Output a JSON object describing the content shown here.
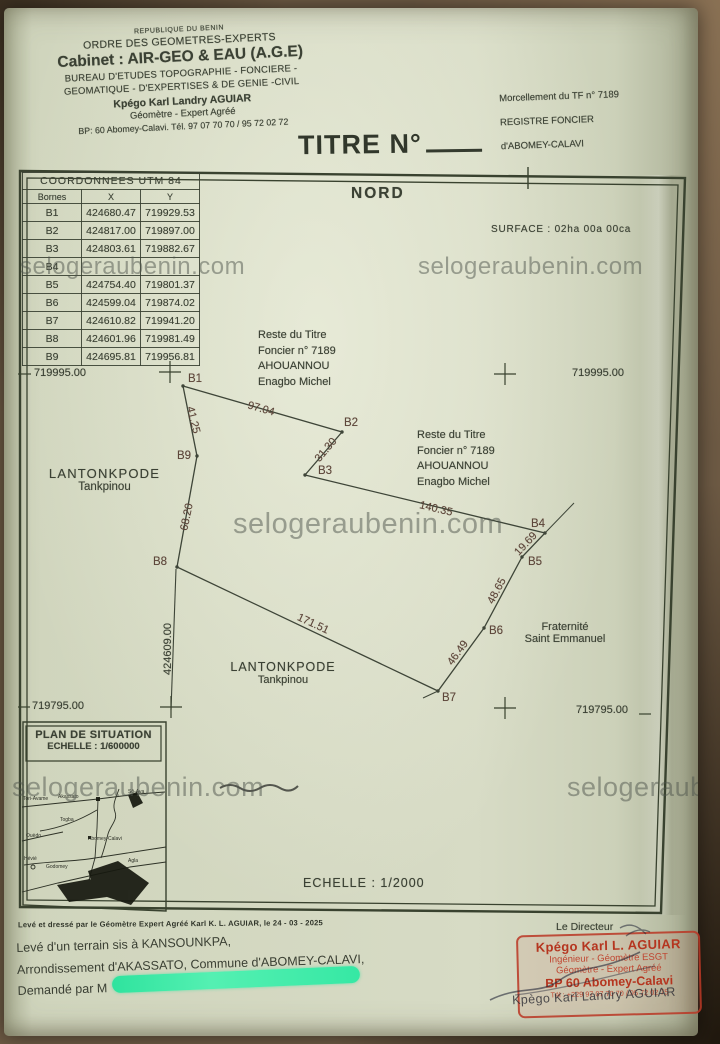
{
  "colors": {
    "paper": "#d0d5bd",
    "ink": "#3b4134",
    "annotation_brown": "#5d463a",
    "stamp_red": "#b5351f",
    "redaction_green": "#2fe39e",
    "watermark_gray": "#4e544c",
    "backdrop_brown": "#6d5a44"
  },
  "watermark_text": "selogeraubenin.com",
  "header": {
    "country": "REPUBLIQUE DU BENIN",
    "order": "ORDRE DES GEOMETRES-EXPERTS",
    "cabinet": "Cabinet : AIR-GEO & EAU (A.G.E)",
    "bureau1": "BUREAU D'ETUDES TOPOGRAPHIE - FONCIERE -",
    "bureau2": "GEOMATIQUE - D'EXPERTISES & DE GENIE -CIVIL",
    "surveyor": "Kpégo Karl Landry AGUIAR",
    "surveyor_title": "Géomètre - Expert Agréé",
    "contact": "BP: 60 Abomey-Calavi. Tél. 97 07 70 70 / 95 72 02 72"
  },
  "ref_block": {
    "line1": "Morcellement du TF n° 7189",
    "line2": "REGISTRE FONCIER",
    "line3": "d'ABOMEY-CALAVI"
  },
  "title": {
    "label": "TITRE N°"
  },
  "coords_table": {
    "title": "COORDONNEES UTM 84",
    "columns": [
      "Bornes",
      "X",
      "Y"
    ],
    "rows": [
      [
        "B1",
        "424680.47",
        "719929.53"
      ],
      [
        "B2",
        "424817.00",
        "719897.00"
      ],
      [
        "B3",
        "424803.61",
        "719882.67"
      ],
      [
        "B4",
        "",
        ""
      ],
      [
        "B5",
        "424754.40",
        "719801.37"
      ],
      [
        "B6",
        "424599.04",
        "719874.02"
      ],
      [
        "B7",
        "424610.82",
        "719941.20"
      ],
      [
        "B8",
        "424601.96",
        "719981.49"
      ],
      [
        "B9",
        "424695.81",
        "719956.81"
      ]
    ]
  },
  "plan": {
    "north_label": "NORD",
    "surface_label": "SURFACE : 02ha 00a 00ca",
    "scale_label": "ECHELLE : 1/2000",
    "grid_labels": {
      "top_left": "719995.00",
      "top_right": "719995.00",
      "bottom_left": "719795.00",
      "bottom_right": "719795.00",
      "x_axis": "424609.00"
    },
    "vertices": [
      "B1",
      "B2",
      "B3",
      "B4",
      "B5",
      "B6",
      "B7",
      "B8",
      "B9"
    ],
    "edges": [
      {
        "from": "B1",
        "to": "B2",
        "length": "97.04"
      },
      {
        "from": "B2",
        "to": "B3",
        "length": "31.30"
      },
      {
        "from": "B3",
        "to": "B4",
        "length": "140.35"
      },
      {
        "from": "B4",
        "to": "B5",
        "length": "19.69"
      },
      {
        "from": "B5",
        "to": "B6",
        "length": "48.65"
      },
      {
        "from": "B6",
        "to": "B7",
        "length": "46.49"
      },
      {
        "from": "B8",
        "to": "B7",
        "length": "171.51"
      },
      {
        "from": "B9",
        "to": "B8",
        "length": "68.20"
      },
      {
        "from": "B1",
        "to": "B9",
        "length": "41.25"
      }
    ],
    "neighbor_labels": {
      "reste_titre_1": [
        "Reste du Titre",
        "Foncier n° 7189",
        "AHOUANNOU",
        "Enagbo Michel"
      ],
      "reste_titre_2": [
        "Reste du Titre",
        "Foncier n° 7189",
        "AHOUANNOU",
        "Enagbo Michel"
      ],
      "lantonkpode_1": [
        "LANTONKPODE",
        "Tankpinou"
      ],
      "lantonkpode_2": [
        "LANTONKPODE",
        "Tankpinou"
      ],
      "fraternite": [
        "Fraternité",
        "Saint Emmanuel"
      ]
    }
  },
  "situation": {
    "title": "PLAN DE SITUATION",
    "scale": "ECHELLE : 1/600000",
    "places": {
      "tori_avame": "Tori-Avame",
      "akassato": "Akassato",
      "so_ava": "Sô-Ava",
      "togba": "Togba",
      "ouedo": "Ouèdo",
      "hevie": "Hévié",
      "abomey_calavi": "Abomey-Calavi",
      "godomey": "Godomey",
      "agla": "Agla"
    }
  },
  "footer": {
    "certified_line": "Levé et dressé par le Géomètre Expert Agréé Karl K. L. AGUIAR, le 24 - 03 - 2025",
    "line1": "Levé d'un terrain sis à KANSOUNKPA,",
    "line2": "Arrondissement d'AKASSATO, Commune d'ABOMEY-CALAVI,",
    "line3_prefix": "Demandé par M",
    "director_label": "Le Directeur"
  },
  "stamp": {
    "name": "Kpégo Karl L. AGUIAR",
    "line2": "Ingénieur - Géomètre ESGT",
    "line3": "Géomètre - Expert Agréé",
    "line4": "BP 60 Abomey-Calavi",
    "line5": "Tél : +229 97 07 70 70 / 95 72 02 75",
    "overlay_name": "Kpègo Karl Landry AGUIAR"
  }
}
